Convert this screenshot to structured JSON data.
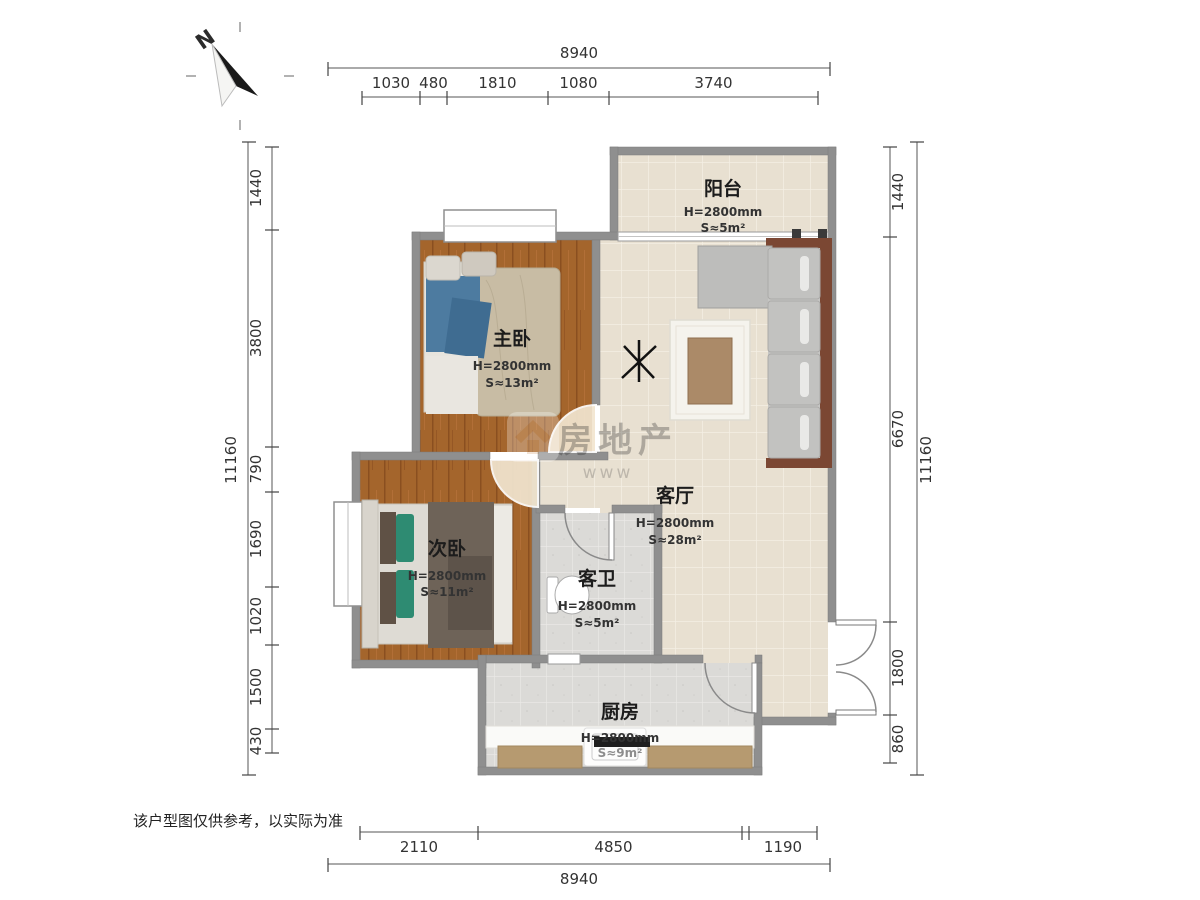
{
  "page": {
    "disclaimer": "该户型图仅供参考，以实际为准"
  },
  "compass": {
    "label": "N"
  },
  "watermark": {
    "icon": "house-icon",
    "text": "房地产",
    "subtext": "www"
  },
  "rooms": [
    {
      "id": "balcony",
      "name": "阳台",
      "height": "H=2800mm",
      "area": "S≈5m²"
    },
    {
      "id": "master-bedroom",
      "name": "主卧",
      "height": "H=2800mm",
      "area": "S≈13m²"
    },
    {
      "id": "living-room",
      "name": "客厅",
      "height": "H=2800mm",
      "area": "S≈28m²"
    },
    {
      "id": "second-bedroom",
      "name": "次卧",
      "height": "H=2800mm",
      "area": "S≈11m²"
    },
    {
      "id": "bathroom",
      "name": "客卫",
      "height": "H=2800mm",
      "area": "S≈5m²"
    },
    {
      "id": "kitchen",
      "name": "厨房",
      "height": "H=2800mm",
      "area": "S≈9m²"
    }
  ],
  "dimensions": {
    "top": {
      "total": "8940",
      "segments": [
        "1030",
        "480",
        "1810",
        "1080",
        "3740"
      ]
    },
    "bottom": {
      "total": "8940",
      "segments": [
        "2110",
        "4850",
        "1190"
      ]
    },
    "left": {
      "total": "11160",
      "segments": [
        "1440",
        "3800",
        "790",
        "1690",
        "1020",
        "1500",
        "430"
      ]
    },
    "right": {
      "total": "11160",
      "segments": [
        "1440",
        "6670",
        "1800",
        "860"
      ]
    }
  },
  "colors": {
    "wall": "#8f8f8f",
    "wood_floor": "#a4652c",
    "tile_floor": "#e8e0d1",
    "wet_floor": "#dbdad7",
    "sofa_frame": "#7b4733",
    "dim_text": "#333333"
  }
}
